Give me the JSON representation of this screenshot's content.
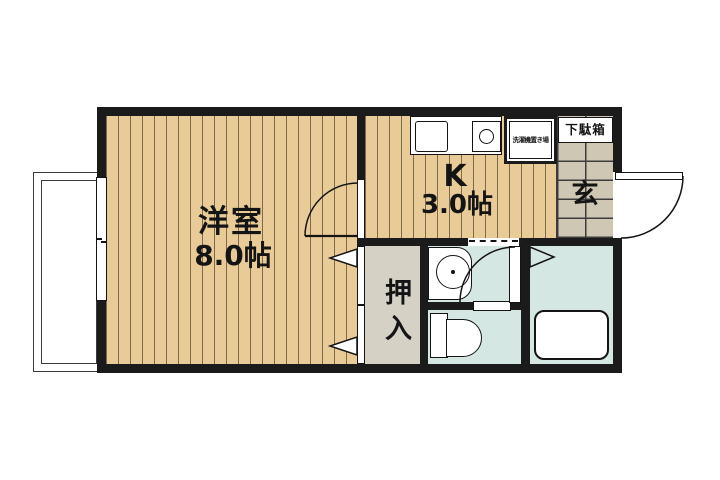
{
  "plan": {
    "type": "apartment-floor-plan",
    "rooms": {
      "western_room": {
        "name": "洋室",
        "size": "8.0帖"
      },
      "kitchen": {
        "name": "K",
        "size": "3.0帖"
      },
      "entrance": {
        "label": "玄"
      },
      "shoe_cabinet": {
        "label": "下駄箱"
      },
      "washing_machine_area": {
        "label": "洗濯機置き場"
      },
      "closet": {
        "label": "押入"
      }
    }
  },
  "colors": {
    "wall": "#1b1b1b",
    "line": "#141414",
    "wood": "#e8cb97",
    "wood_stripe": "#7d6b4c",
    "tile": "#cdc7b4",
    "tile_line": "#3c3c3c",
    "water": "#d5e7e3",
    "closet": "#d5d1c5",
    "balcony_line": "#3a3a3a"
  }
}
